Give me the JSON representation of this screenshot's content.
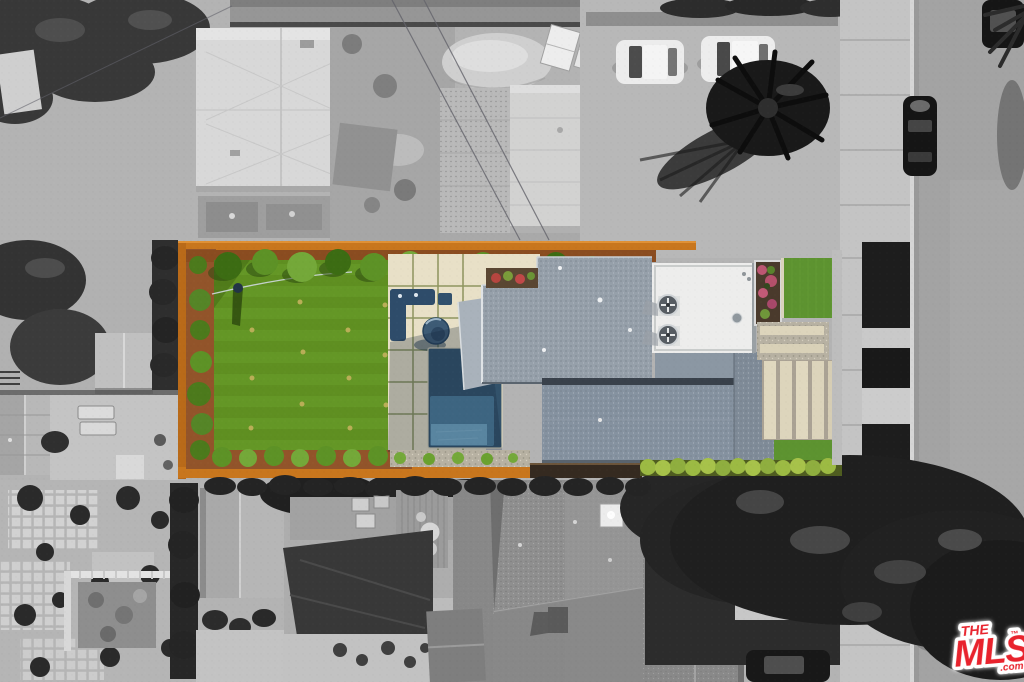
{
  "meta": {
    "width": 1024,
    "height": 682,
    "kind": "aerial-photo"
  },
  "watermark": {
    "the": "THE",
    "mls": "MLS",
    "tm": "™",
    "dotcom": ".com",
    "red": "#e8232d",
    "glow": "#ffffff"
  },
  "palette": {
    "lawn": "#5f8f21",
    "lawn_stripe": "#6aa02c",
    "hedge_dark": "#3c6c13",
    "hedge_mid": "#5d9226",
    "hedge_light": "#74a839",
    "hedge_yellow": "#9cba43",
    "mulch": "#92542a",
    "fence_orange": "#c8761d",
    "patio_cream": "#e8e0c7",
    "gravel": "#b7b1a2",
    "pool_dark": "#32526b",
    "pool_mid": "#4d7d9c",
    "pool_light": "#74a9c6",
    "spa_blue": "#3d5b75",
    "couch_navy": "#2e4c6a",
    "roof_main": "#96a0aa",
    "roof_lower": "#8592a0",
    "roof_side": "#7f8b98",
    "roof_white": "#ededec",
    "flower_pink": "#bc5672",
    "flower_soil": "#4a3a2c",
    "grass_front": "#5d9330",
    "street_gray": "#a3a3a3",
    "sidewalk_gray": "#c4c4c4",
    "parkway_dark": "#1d1d1d",
    "ground_gray": "#b3b3b3",
    "building_light": "#d8d8d8",
    "tree_dark": "#232323",
    "car_white": "#ececec",
    "car_black": "#151515"
  }
}
